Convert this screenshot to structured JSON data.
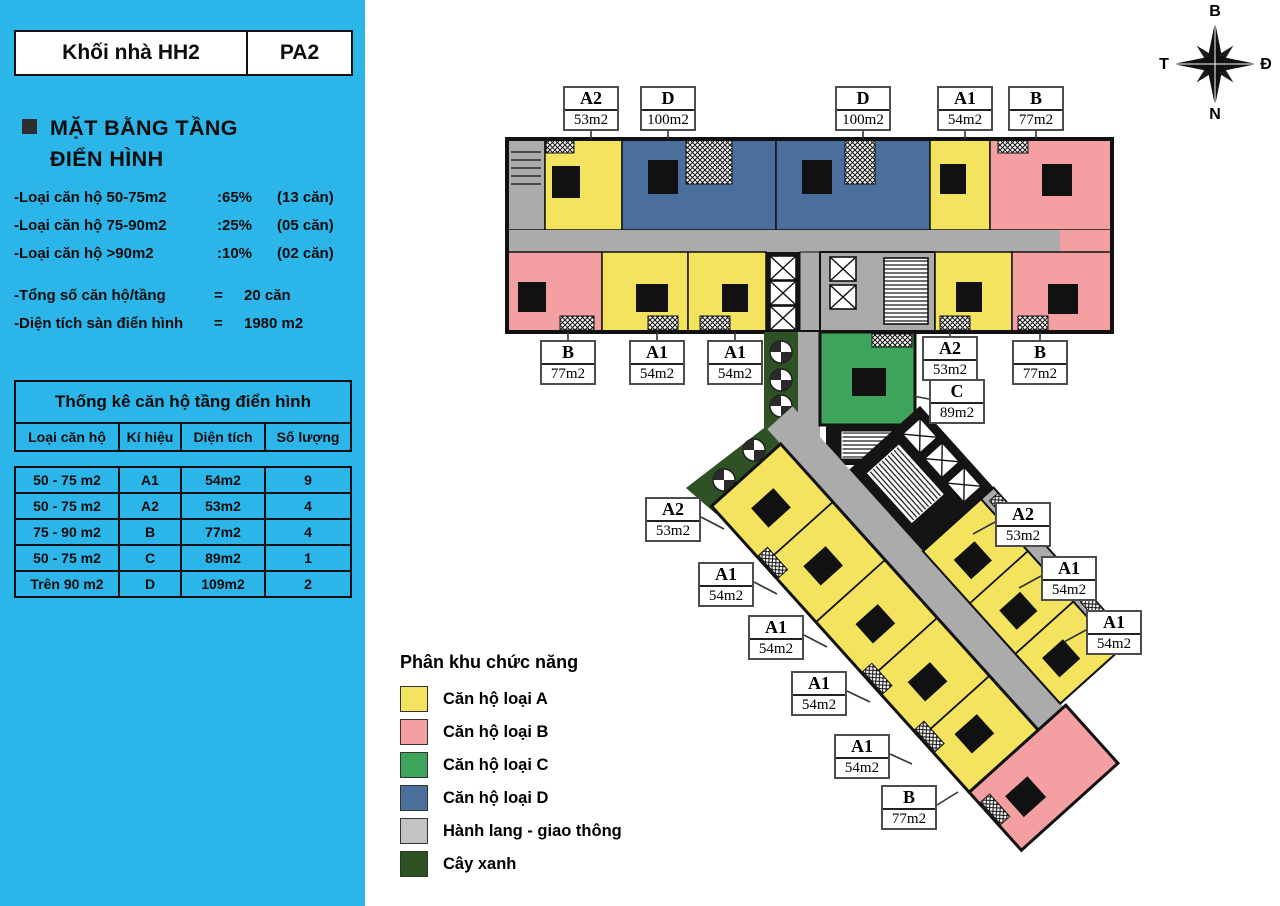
{
  "header": {
    "block_name": "Khối nhà HH2",
    "plan_code": "PA2"
  },
  "sidebar": {
    "section_title": [
      "MẶT BẰNG TẦNG",
      "ĐIỂN HÌNH"
    ],
    "stats": [
      {
        "label": "-Loại căn hộ 50-75m2",
        "pct": ":65%",
        "count": "(13 căn)"
      },
      {
        "label": "-Loại căn hộ 75-90m2",
        "pct": ":25%",
        "count": "(05 căn)"
      },
      {
        "label": "-Loại căn hộ >90m2",
        "pct": ":10%",
        "count": "(02 căn)"
      }
    ],
    "totals": [
      {
        "label": "-Tổng số căn hộ/tầng",
        "eq": "=",
        "value": "20 căn"
      },
      {
        "label": "-Diện tích sàn điển hình",
        "eq": "=",
        "value": "1980 m2"
      }
    ],
    "table": {
      "title": "Thống kê căn hộ tầng điển hình",
      "columns": [
        "Loại căn hộ",
        "Kí hiệu",
        "Diện tích",
        "Số lượng"
      ],
      "rows": [
        [
          "50 - 75 m2",
          "A1",
          "54m2",
          "9"
        ],
        [
          "50 - 75 m2",
          "A2",
          "53m2",
          "4"
        ],
        [
          "75 - 90 m2",
          "B",
          "77m2",
          "4"
        ],
        [
          "50 - 75 m2",
          "C",
          "89m2",
          "1"
        ],
        [
          "Trên 90 m2",
          "D",
          "109m2",
          "2"
        ]
      ]
    }
  },
  "legend": {
    "title": "Phân khu chức năng",
    "items": [
      {
        "label": "Căn hộ loại A",
        "color": "#F3E35F"
      },
      {
        "label": "Căn hộ loại B",
        "color": "#F4A0A3"
      },
      {
        "label": "Căn hộ loại C",
        "color": "#3EA45B"
      },
      {
        "label": "Căn hộ loại D",
        "color": "#4A6F9C"
      },
      {
        "label": "Hành lang - giao thông",
        "color": "#C3C3C3"
      },
      {
        "label": "Cây xanh",
        "color": "#2C5222"
      }
    ]
  },
  "compass": {
    "north": "B",
    "east": "Đ",
    "south": "N",
    "west": "T"
  },
  "plan": {
    "unit_labels": [
      {
        "type": "A2",
        "area": "53m2"
      },
      {
        "type": "D",
        "area": "100m2"
      },
      {
        "type": "D",
        "area": "100m2"
      },
      {
        "type": "A1",
        "area": "54m2"
      },
      {
        "type": "B",
        "area": "77m2"
      },
      {
        "type": "B",
        "area": "77m2"
      },
      {
        "type": "A1",
        "area": "54m2"
      },
      {
        "type": "A1",
        "area": "54m2"
      },
      {
        "type": "A2",
        "area": "53m2"
      },
      {
        "type": "B",
        "area": "77m2"
      },
      {
        "type": "C",
        "area": "89m2"
      },
      {
        "type": "A2",
        "area": "53m2"
      },
      {
        "type": "A1",
        "area": "54m2"
      },
      {
        "type": "A1",
        "area": "54m2"
      },
      {
        "type": "A1",
        "area": "54m2"
      },
      {
        "type": "A1",
        "area": "54m2"
      },
      {
        "type": "B",
        "area": "77m2"
      },
      {
        "type": "A2",
        "area": "53m2"
      },
      {
        "type": "A1",
        "area": "54m2"
      },
      {
        "type": "A1",
        "area": "54m2"
      }
    ]
  },
  "colors": {
    "sidebar_bg": "#2CB5E9",
    "unit_a": "#F3E35F",
    "unit_b": "#F4A0A3",
    "unit_c": "#3EA45B",
    "unit_d": "#4A6F9C",
    "corridor": "#ABABAB",
    "greenery": "#2E5226",
    "core": "#141414"
  }
}
